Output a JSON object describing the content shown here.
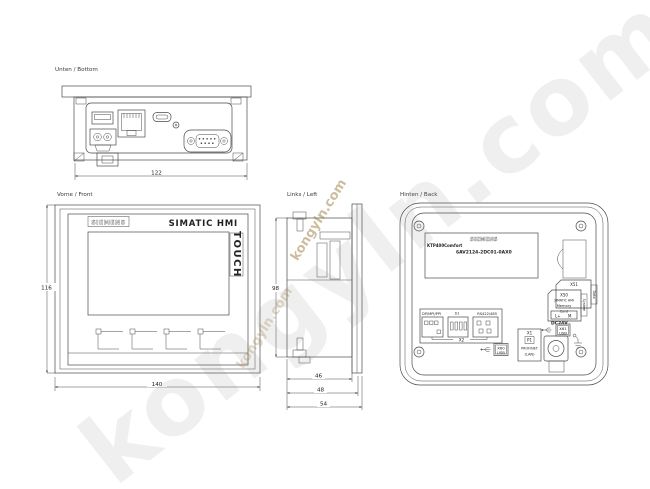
{
  "watermark": {
    "text": "kongyln.com"
  },
  "views": {
    "bottom": {
      "label": "Unten / Bottom",
      "dim_width": "122"
    },
    "front": {
      "label": "Vorne / Front",
      "brand": "SIEMENS",
      "product": "SIMATIC HMI",
      "touch_label": "TOUCH",
      "dim_height": "116",
      "dim_width": "140"
    },
    "left": {
      "label": "Links / Left",
      "dim_height": "98",
      "dim_depth_inner": "46",
      "dim_depth_mid": "48",
      "dim_depth_outer": "54"
    },
    "back": {
      "label": "Hinten / Back",
      "nameplate": {
        "brand": "SIEMENS",
        "model": "KTP400Comfort",
        "order_no": "6AV2124-2DC01-0AX0"
      },
      "memory_cards": {
        "slot2_id": "X51",
        "slot2_tab": "Data",
        "slot1_id": "X50",
        "slot1_line1": "SIMATIC HMI",
        "slot1_line2": "Memory",
        "slot1_line3": "Card",
        "slot1_tab": "System"
      },
      "power": {
        "terminal_l": "L+",
        "terminal_m": "M",
        "rating": "DC24V"
      },
      "usb_right": {
        "id": "X61",
        "type": "USB"
      },
      "usb_bottom": {
        "id": "X60",
        "type": "USB"
      },
      "interface_x2": {
        "left_label": "DP/MPI/PPI",
        "dip_label": "S1",
        "right_label": "RS422/485",
        "id": "X2"
      },
      "profinet": {
        "id": "X1",
        "port_label": "P1",
        "line1": "PROFINET",
        "line2": "(LAN)"
      }
    }
  }
}
